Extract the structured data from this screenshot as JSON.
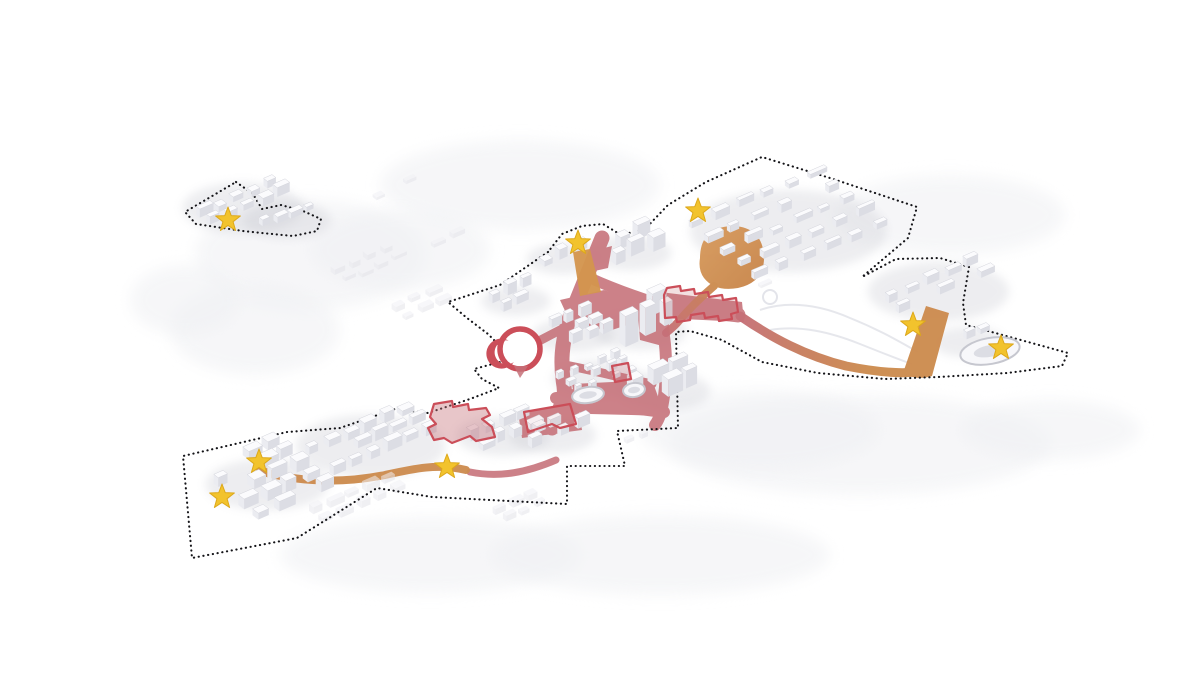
{
  "canvas": {
    "width": 1200,
    "height": 692,
    "background": "#ffffff"
  },
  "diagram": {
    "kind": "axonometric-urban-masterplan",
    "marker_count": 8
  },
  "palette": {
    "boundary_dots": "#141418",
    "red_route": "#c67078",
    "red_outline": "#cb4e59",
    "orange_route": "#cd8c4f",
    "orange_route_light": "#d3954e",
    "star_fill": "#f2c32d",
    "star_edge": "#dda81a",
    "building_top": "#fbfbfd",
    "building_side": "#ebecf1",
    "building_front": "#dcdde4",
    "building_edge": "#d3d4db",
    "ghost_top": "#f2f2f6",
    "ghost_side": "#eaeaef",
    "ghost_front": "#e4e4ea",
    "terrain": "#eff0f3",
    "shadow": "#c9cad2",
    "park_path": "#e3e4ea",
    "oval_stroke": "#c6c7cf",
    "oval_fill": "#f7f7fa",
    "oval_inner": "#dcdde4"
  },
  "boundaries": [
    {
      "name": "satellite-district-outline",
      "points": [
        [
          236,
          182
        ],
        [
          253,
          194
        ],
        [
          262,
          209
        ],
        [
          281,
          205
        ],
        [
          303,
          211
        ],
        [
          321,
          219
        ],
        [
          317,
          231
        ],
        [
          293,
          236
        ],
        [
          262,
          233
        ],
        [
          243,
          231
        ],
        [
          196,
          224
        ],
        [
          185,
          212
        ]
      ]
    },
    {
      "name": "main-district-outline",
      "points": [
        [
          548,
          252
        ],
        [
          500,
          285
        ],
        [
          448,
          302
        ],
        [
          467,
          318
        ],
        [
          488,
          334
        ],
        [
          502,
          348
        ],
        [
          504,
          361
        ],
        [
          474,
          369
        ],
        [
          482,
          379
        ],
        [
          499,
          388
        ],
        [
          470,
          399
        ],
        [
          428,
          413
        ],
        [
          395,
          409
        ],
        [
          340,
          428
        ],
        [
          287,
          432
        ],
        [
          183,
          456
        ],
        [
          192,
          558
        ],
        [
          297,
          538
        ],
        [
          377,
          488
        ],
        [
          432,
          497
        ],
        [
          490,
          500
        ],
        [
          567,
          504
        ],
        [
          567,
          466
        ],
        [
          625,
          466
        ],
        [
          617,
          431
        ],
        [
          678,
          428
        ],
        [
          676,
          332
        ],
        [
          690,
          331
        ],
        [
          722,
          340
        ],
        [
          762,
          362
        ],
        [
          818,
          373
        ],
        [
          885,
          379
        ],
        [
          938,
          377
        ],
        [
          1007,
          373
        ],
        [
          1062,
          366
        ],
        [
          1068,
          353
        ],
        [
          999,
          334
        ],
        [
          966,
          325
        ],
        [
          963,
          303
        ],
        [
          969,
          267
        ],
        [
          940,
          258
        ],
        [
          896,
          259
        ],
        [
          862,
          277
        ],
        [
          908,
          238
        ],
        [
          917,
          207
        ],
        [
          830,
          178
        ],
        [
          762,
          157
        ],
        [
          706,
          182
        ],
        [
          668,
          205
        ],
        [
          645,
          229
        ],
        [
          621,
          235
        ],
        [
          603,
          224
        ],
        [
          582,
          226
        ],
        [
          562,
          234
        ]
      ]
    }
  ],
  "terrain_blobs": [
    [
      310,
      255,
      115,
      55
    ],
    [
      255,
      330,
      85,
      45
    ],
    [
      520,
      185,
      140,
      45
    ],
    [
      860,
      445,
      190,
      50
    ],
    [
      430,
      555,
      150,
      38
    ],
    [
      950,
      215,
      115,
      40
    ],
    [
      660,
      555,
      170,
      40
    ],
    [
      185,
      300,
      55,
      35
    ],
    [
      400,
      250,
      90,
      40
    ],
    [
      760,
      430,
      120,
      40
    ],
    [
      1050,
      430,
      90,
      30
    ]
  ],
  "park_paths": [
    "M760,310 C790,300 820,305 850,318 C880,330 900,342 918,352",
    "M770,330 C800,325 830,332 860,344 C885,354 900,360 912,364"
  ],
  "park_circle": {
    "cx": 770,
    "cy": 297,
    "r": 7
  },
  "red_network": {
    "patches": [
      "M560,300 L604,290 L640,302 L648,318 L612,330 L572,326 Z",
      "M560,388 L664,398 L668,416 L590,414 L552,408 Z",
      "M660,292 L742,302 L744,322 L662,318 Z",
      "M588,252 L612,246 L608,268 L590,272 Z",
      "M518,412 L578,404 L582,430 L522,438 Z",
      "M572,384 L652,380 L660,402 L576,408 Z",
      "M636,292 L668,300 L670,348 L640,340 Z"
    ],
    "strokes": [
      {
        "d": "M602,238 C592,262 580,292 568,322 C562,344 560,362 564,386 C566,404 560,418 552,428",
        "w": 15
      },
      {
        "d": "M590,278 C612,288 634,296 662,305",
        "w": 11
      },
      {
        "d": "M662,305 C690,310 715,312 738,315",
        "w": 15
      },
      {
        "d": "M568,326 C548,336 534,344 521,350",
        "w": 9
      },
      {
        "d": "M560,364 C592,370 622,378 652,384",
        "w": 9
      },
      {
        "d": "M556,398 C590,402 630,408 664,412",
        "w": 12
      },
      {
        "d": "M658,308 C666,336 668,366 664,396 C662,410 660,418 655,425",
        "w": 12
      },
      {
        "d": "M552,430 C540,432 528,432 518,428",
        "w": 8
      },
      {
        "d": "M470,472 C500,478 528,472 556,460",
        "w": 7
      }
    ]
  },
  "red_outlines": [
    {
      "name": "highlighted-block-zigzag",
      "d": "M664,295 L667,288 L680,286 L681,291 L694,289 L695,294 L708,292 L709,297 L722,295 L723,300 L736,298 L738,312 L731,314 L732,319 L719,321 L718,316 L705,318 L704,313 L691,315 L690,320 L677,322 L676,317 L665,318 Z",
      "fill_opacity": 0.22
    },
    {
      "name": "highlighted-block-southwest",
      "d": "M430,417 L434,404 L452,401 L453,407 L468,404 L469,410 L486,408 L490,415 L482,419 L492,427 L495,437 L476,441 L470,436 L452,443 L444,438 L434,440 L428,428 L436,424 Z",
      "fill_opacity": 0.4
    },
    {
      "name": "highlighted-building-south",
      "d": "M524,412 L570,404 L576,424 L560,428 L552,424 L528,432 Z",
      "fill_opacity": 0.08
    },
    {
      "name": "highlighted-building-small",
      "d": "M612,366 L628,363 L631,379 L615,382 Z",
      "fill_opacity": 0.25
    }
  ],
  "circular_landmark": {
    "cx": 520,
    "cy": 349,
    "r": 20
  },
  "oval_buildings": [
    {
      "cx": 588,
      "cy": 395,
      "rx": 16,
      "ry": 8,
      "rot": -8
    },
    {
      "cx": 634,
      "cy": 390,
      "rx": 11,
      "ry": 7,
      "rot": -8
    },
    {
      "cx": 990,
      "cy": 351,
      "rx": 30,
      "ry": 13,
      "rot": -10
    }
  ],
  "orange_routes": {
    "west_band": {
      "d": "M263,472 C305,483 345,483 385,475 C412,469 438,463 466,470",
      "w": 8
    },
    "west_band_start": {
      "cx": 262,
      "cy": 471,
      "r": 6
    },
    "east_sweep": {
      "d": "M740,316 C772,338 806,356 846,366 C876,372 898,374 916,372",
      "w": 9
    },
    "east_wedge": "M903,373 L926,306 L949,313 L932,376 Q916,381 903,373 Z",
    "north_blob": "M700,258 Q700,228 731,226 Q762,226 764,256 Q765,282 738,288 Q715,292 704,278 Q698,270 700,258 Z",
    "north_blob_stem": {
      "d": "M714,286 C700,298 688,310 678,322 C673,328 669,330 666,333",
      "w": 8
    },
    "star_stem": "M573,252 L590,249 L601,292 L580,296 Z"
  },
  "building_clusters": [
    {
      "name": "satellite-a",
      "x": 196,
      "y": 214,
      "cols": 5,
      "rows": 2,
      "ux": 17,
      "uy": -7,
      "vx": 10,
      "vy": 8,
      "a": 13,
      "b": 7,
      "h": 7,
      "seed": 1,
      "ghost": false
    },
    {
      "name": "satellite-b",
      "x": 258,
      "y": 224,
      "cols": 4,
      "rows": 1,
      "ux": 15,
      "uy": -5,
      "vx": 8,
      "vy": 7,
      "a": 11,
      "b": 6,
      "h": 5,
      "seed": 2,
      "ghost": false
    },
    {
      "name": "nw-of-center",
      "x": 489,
      "y": 300,
      "cols": 3,
      "rows": 2,
      "ux": 15,
      "uy": -7,
      "vx": 10,
      "vy": 8,
      "a": 11,
      "b": 6,
      "h": 8,
      "seed": 3,
      "ghost": false
    },
    {
      "name": "center-upper",
      "x": 598,
      "y": 252,
      "cols": 3,
      "rows": 2,
      "ux": 18,
      "uy": -8,
      "vx": 12,
      "vy": 10,
      "a": 13,
      "b": 8,
      "h": 11,
      "seed": 4,
      "ghost": false
    },
    {
      "name": "center-corridor",
      "x": 540,
      "y": 262,
      "cols": 3,
      "rows": 1,
      "ux": 16,
      "uy": -7,
      "vx": 10,
      "vy": 8,
      "a": 11,
      "b": 7,
      "h": 8,
      "seed": 5,
      "ghost": false
    },
    {
      "name": "center-west",
      "x": 536,
      "y": 332,
      "cols": 4,
      "rows": 3,
      "ux": 14,
      "uy": -6,
      "vx": 10,
      "vy": 8,
      "a": 10,
      "b": 6,
      "h": 8,
      "seed": 6,
      "ghost": false
    },
    {
      "name": "center-towers",
      "x": 604,
      "y": 330,
      "cols": 3,
      "rows": 2,
      "ux": 21,
      "uy": -9,
      "vx": 14,
      "vy": 11,
      "a": 13,
      "b": 8,
      "h": 24,
      "seed": 7,
      "ghost": false
    },
    {
      "name": "center-dense",
      "x": 557,
      "y": 378,
      "cols": 5,
      "rows": 3,
      "ux": 13,
      "uy": -5,
      "vx": 9,
      "vy": 7,
      "a": 8,
      "b": 5,
      "h": 6,
      "seed": 8,
      "ghost": false
    },
    {
      "name": "center-east",
      "x": 628,
      "y": 390,
      "cols": 3,
      "rows": 2,
      "ux": 20,
      "uy": -8,
      "vx": 13,
      "vy": 10,
      "a": 15,
      "b": 9,
      "h": 13,
      "seed": 9,
      "ghost": false
    },
    {
      "name": "center-south",
      "x": 518,
      "y": 436,
      "cols": 4,
      "rows": 2,
      "ux": 15,
      "uy": -6,
      "vx": 10,
      "vy": 8,
      "a": 11,
      "b": 6,
      "h": 8,
      "seed": 10,
      "ghost": false
    },
    {
      "name": "northeast-rows",
      "x": 688,
      "y": 226,
      "cols": 6,
      "rows": 5,
      "ux": 24,
      "uy": -10,
      "vx": 16,
      "vy": 13,
      "a": 15,
      "b": 6,
      "h": 6,
      "seed": 11,
      "ghost": false
    },
    {
      "name": "east-rows",
      "x": 884,
      "y": 300,
      "cols": 5,
      "rows": 2,
      "ux": 20,
      "uy": -9,
      "vx": 13,
      "vy": 11,
      "a": 14,
      "b": 6,
      "h": 7,
      "seed": 12,
      "ghost": false
    },
    {
      "name": "east-extra",
      "x": 946,
      "y": 345,
      "cols": 3,
      "rows": 1,
      "ux": 16,
      "uy": -7,
      "vx": 10,
      "vy": 8,
      "a": 11,
      "b": 5,
      "h": 6,
      "seed": 13,
      "ghost": false
    },
    {
      "name": "strip-west",
      "x": 306,
      "y": 452,
      "cols": 6,
      "rows": 3,
      "ux": 18,
      "uy": -8,
      "vx": 12,
      "vy": 10,
      "a": 13,
      "b": 7,
      "h": 8,
      "seed": 14,
      "ghost": false
    },
    {
      "name": "strip-east",
      "x": 466,
      "y": 438,
      "cols": 4,
      "rows": 2,
      "ux": 16,
      "uy": -7,
      "vx": 11,
      "vy": 9,
      "a": 12,
      "b": 7,
      "h": 8,
      "seed": 15,
      "ghost": false
    },
    {
      "name": "block-southwest",
      "x": 200,
      "y": 472,
      "cols": 4,
      "rows": 5,
      "ux": 21,
      "uy": -9,
      "vx": 13,
      "vy": 11,
      "a": 15,
      "b": 9,
      "h": 9,
      "seed": 16,
      "ghost": false
    },
    {
      "name": "ghost-a",
      "x": 332,
      "y": 272,
      "cols": 4,
      "rows": 2,
      "ux": 16,
      "uy": -7,
      "vx": 10,
      "vy": 8,
      "a": 12,
      "b": 6,
      "h": 5,
      "seed": 21,
      "ghost": true
    },
    {
      "name": "ghost-b",
      "x": 392,
      "y": 308,
      "cols": 3,
      "rows": 2,
      "ux": 16,
      "uy": -7,
      "vx": 10,
      "vy": 8,
      "a": 12,
      "b": 6,
      "h": 5,
      "seed": 22,
      "ghost": true
    },
    {
      "name": "ghost-c",
      "x": 308,
      "y": 512,
      "cols": 5,
      "rows": 2,
      "ux": 18,
      "uy": -8,
      "vx": 11,
      "vy": 9,
      "a": 13,
      "b": 7,
      "h": 6,
      "seed": 23,
      "ghost": true
    },
    {
      "name": "ghost-d",
      "x": 492,
      "y": 512,
      "cols": 3,
      "rows": 2,
      "ux": 16,
      "uy": -7,
      "vx": 10,
      "vy": 8,
      "a": 11,
      "b": 6,
      "h": 5,
      "seed": 24,
      "ghost": true
    },
    {
      "name": "ghost-e",
      "x": 432,
      "y": 244,
      "cols": 2,
      "rows": 1,
      "ux": 16,
      "uy": -7,
      "vx": 10,
      "vy": 8,
      "a": 11,
      "b": 6,
      "h": 5,
      "seed": 25,
      "ghost": true
    },
    {
      "name": "ghost-f",
      "x": 742,
      "y": 292,
      "cols": 2,
      "rows": 1,
      "ux": 16,
      "uy": -7,
      "vx": 10,
      "vy": 8,
      "a": 11,
      "b": 6,
      "h": 4,
      "seed": 26,
      "ghost": true
    },
    {
      "name": "ghost-g",
      "x": 372,
      "y": 196,
      "cols": 3,
      "rows": 1,
      "ux": 16,
      "uy": -7,
      "vx": 10,
      "vy": 8,
      "a": 11,
      "b": 6,
      "h": 4,
      "seed": 27,
      "ghost": true
    },
    {
      "name": "ghost-h",
      "x": 612,
      "y": 446,
      "cols": 3,
      "rows": 1,
      "ux": 13,
      "uy": -5,
      "vx": 9,
      "vy": 7,
      "a": 8,
      "b": 5,
      "h": 4,
      "seed": 28,
      "ghost": true
    }
  ],
  "star_markers": [
    {
      "id": "site-1",
      "x": 228,
      "y": 220
    },
    {
      "id": "site-2",
      "x": 578,
      "y": 243
    },
    {
      "id": "site-3",
      "x": 698,
      "y": 211
    },
    {
      "id": "site-4",
      "x": 913,
      "y": 325
    },
    {
      "id": "site-5",
      "x": 1001,
      "y": 348
    },
    {
      "id": "site-6",
      "x": 259,
      "y": 462
    },
    {
      "id": "site-7",
      "x": 222,
      "y": 497
    },
    {
      "id": "site-8",
      "x": 447,
      "y": 467
    }
  ]
}
